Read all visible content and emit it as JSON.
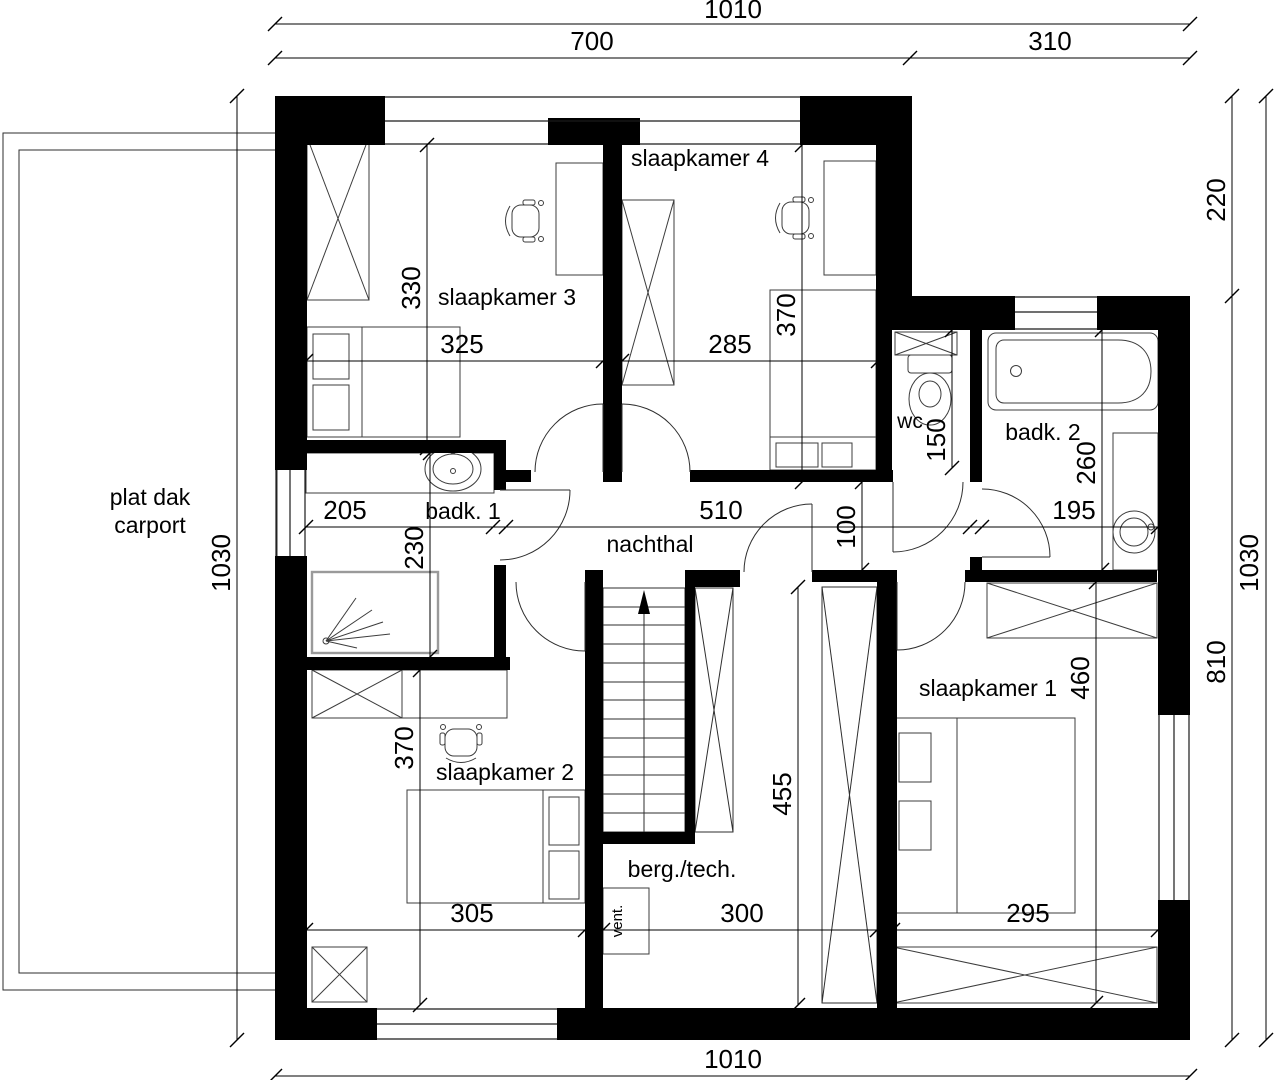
{
  "rooms": {
    "slaapkamer_1": "slaapkamer 1",
    "slaapkamer_2": "slaapkamer 2",
    "slaapkamer_3": "slaapkamer 3",
    "slaapkamer_4": "slaapkamer 4",
    "badkamer_1": "badk. 1",
    "badkamer_2": "badk. 2",
    "wc": "wc",
    "nachthal": "nachthal",
    "berging": "berg./tech.",
    "ventilatie": "vent.",
    "carport_line1": "plat dak",
    "carport_line2": "carport"
  },
  "dimensions_cm": {
    "top_total": "1010",
    "top_left": "700",
    "top_right": "310",
    "bottom_total": "1010",
    "left_height": "1030",
    "right_height": "1030",
    "right_setback": "220",
    "right_main": "810",
    "slaapkamer3_width": "325",
    "slaapkamer3_depth": "330",
    "slaapkamer4_width": "285",
    "slaapkamer4_depth": "370",
    "badkamer1_width": "205",
    "badkamer1_depth": "230",
    "nachthal_length": "510",
    "nachthal_width": "100",
    "wc_depth": "150",
    "badkamer2_width": "195",
    "badkamer2_depth": "260",
    "slaapkamer2_width": "305",
    "slaapkamer2_depth": "370",
    "trap_zone_depth": "455",
    "berging_width": "300",
    "slaapkamer1_width": "295",
    "slaapkamer1_depth": "460"
  },
  "colors": {
    "wall": "#000000",
    "line": "#3a3a3a",
    "shower_line": "#9a9a9a",
    "background": "#ffffff"
  }
}
